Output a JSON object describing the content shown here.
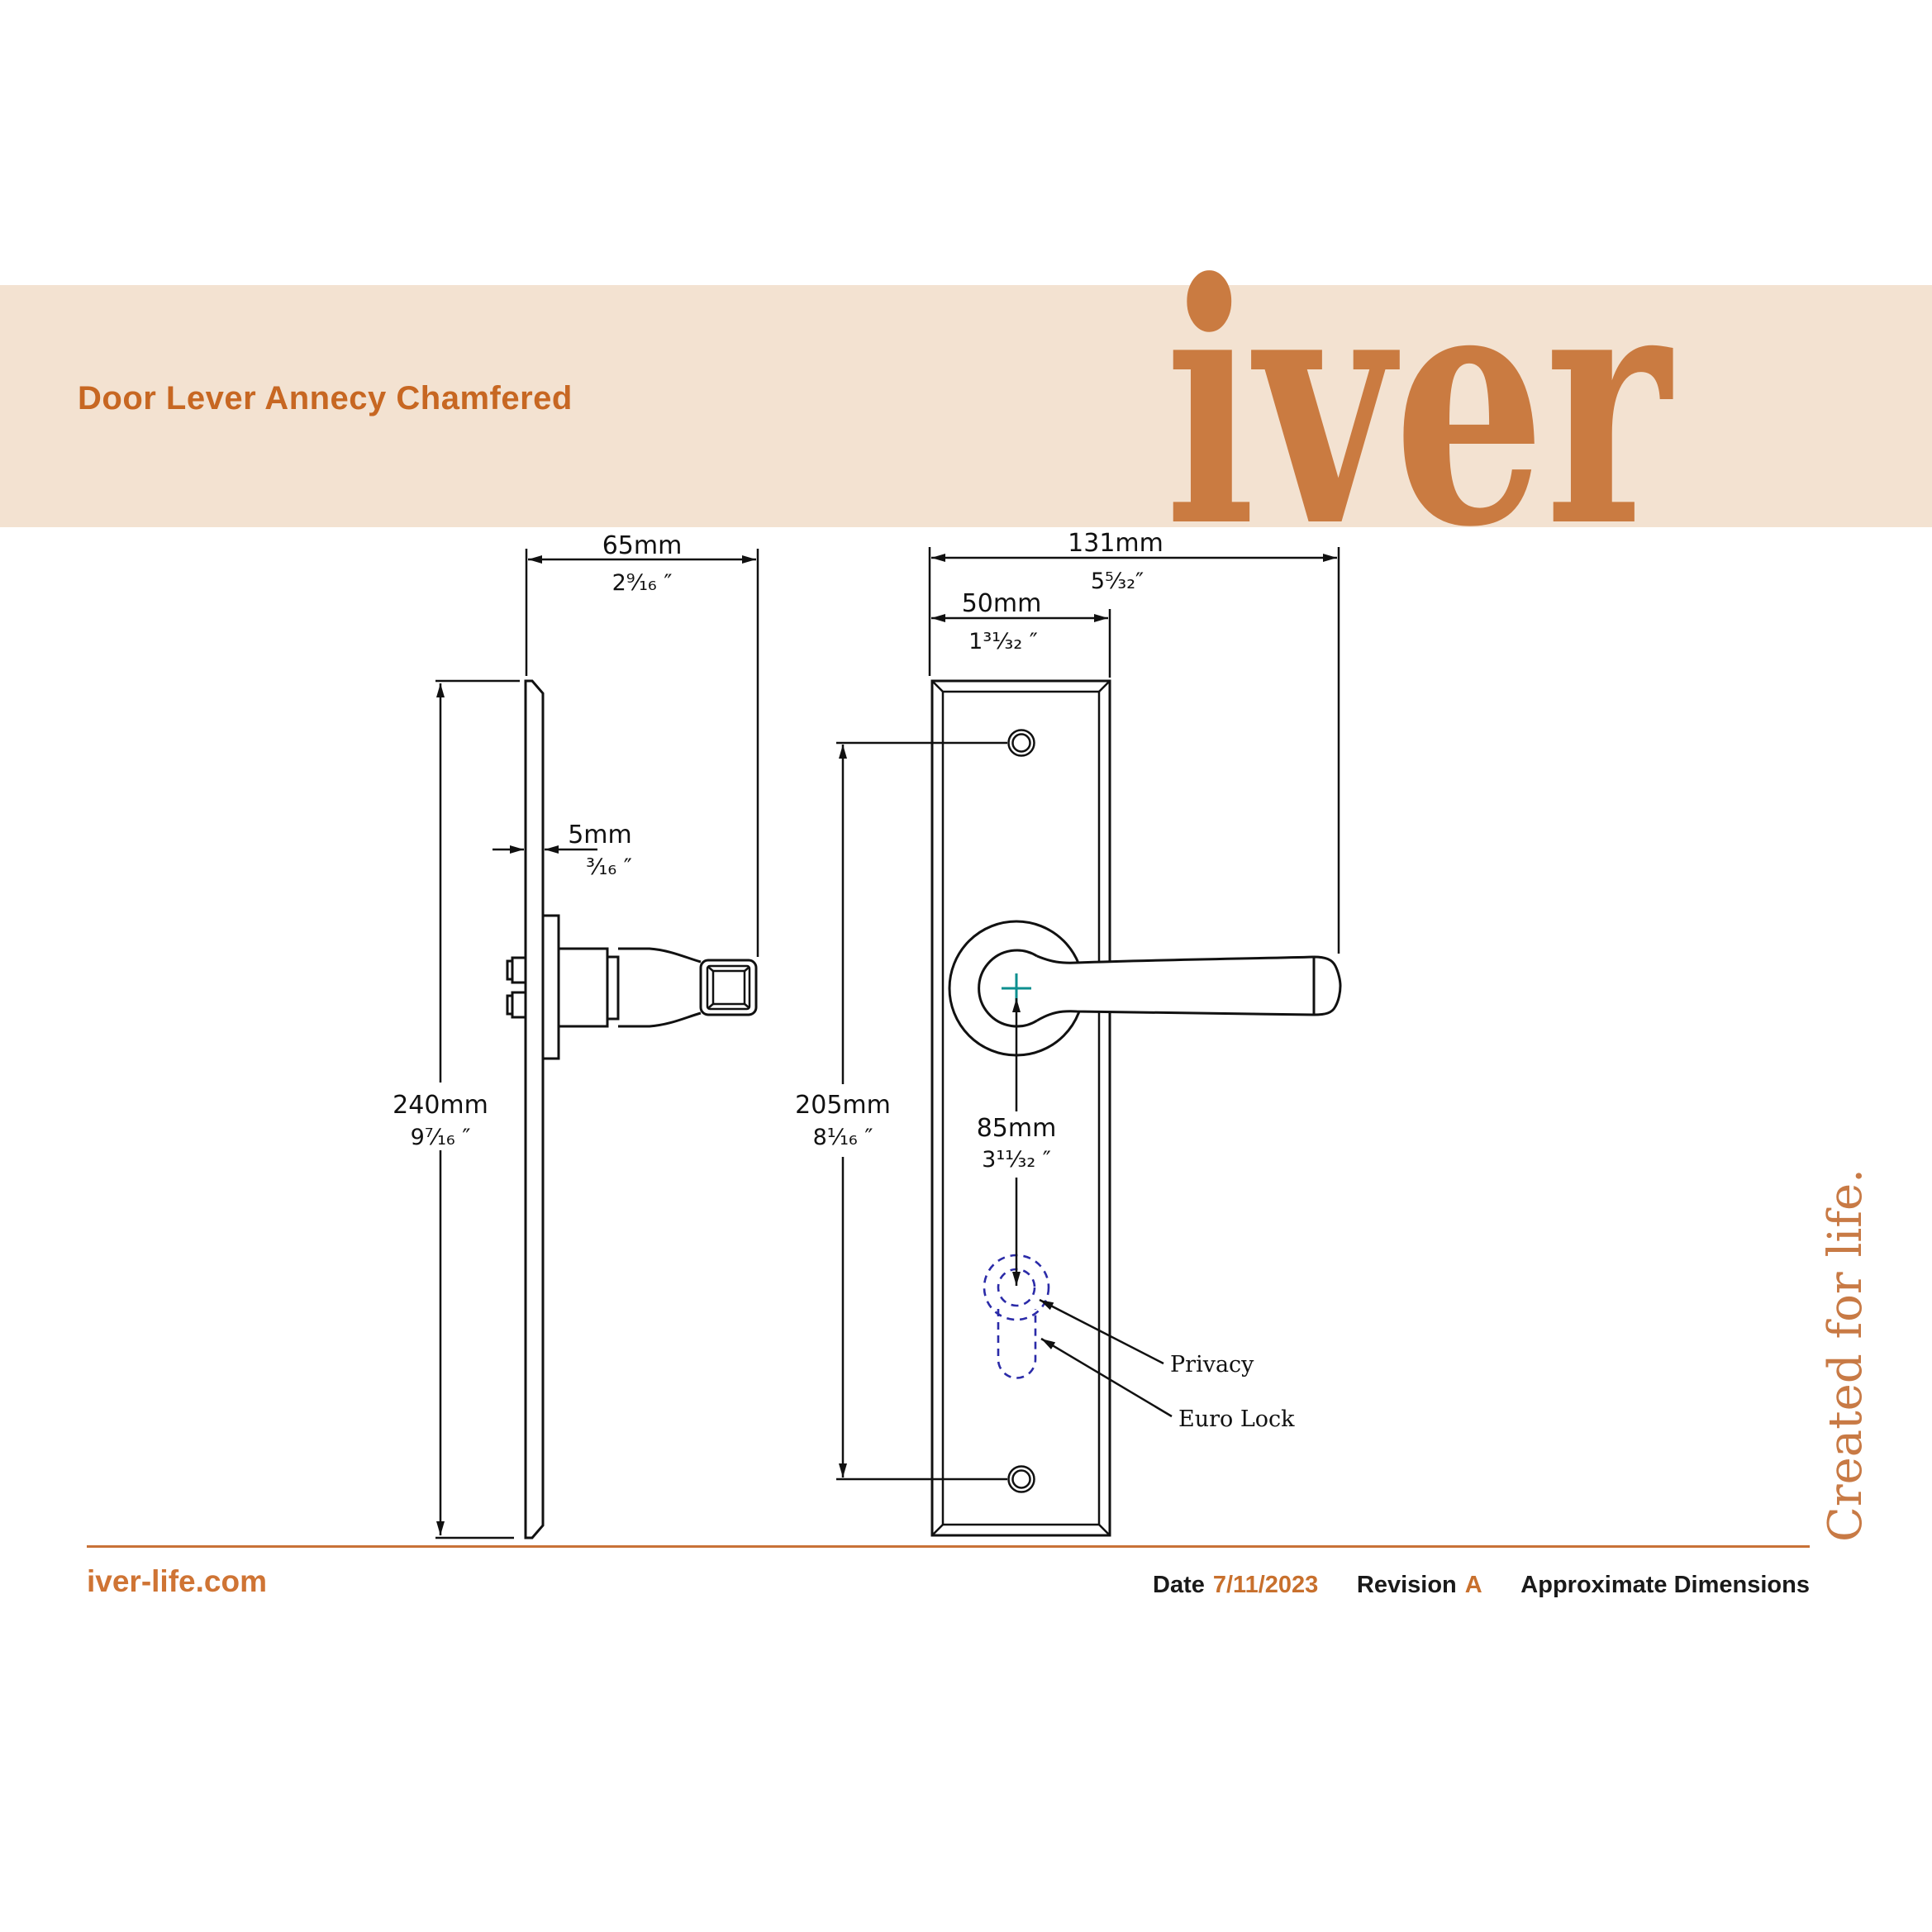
{
  "header": {
    "title": "Door Lever Annecy Chamfered",
    "logo": "iver",
    "tagline": "Created for life."
  },
  "views": {
    "side": {
      "width": {
        "mm": "65mm",
        "inch": "2⁹⁄₁₆ ″"
      },
      "thickness": {
        "mm": "5mm",
        "inch": "³⁄₁₆ ″"
      },
      "height": {
        "mm": "240mm",
        "inch": "9⁷⁄₁₆ ″"
      }
    },
    "front": {
      "total_width": {
        "mm": "131mm",
        "inch": "5⁵⁄₃₂″"
      },
      "plate_width": {
        "mm": "50mm",
        "inch": "1³¹⁄₃₂ ″"
      },
      "hole_spacing": {
        "mm": "205mm",
        "inch": "8¹⁄₁₆ ″"
      },
      "keyhole_offset": {
        "mm": "85mm",
        "inch": "3¹¹⁄₃₂ ″"
      },
      "callouts": {
        "privacy": "Privacy",
        "euro_lock": "Euro Lock"
      }
    }
  },
  "footer": {
    "website": "iver-life.com",
    "date_label": "Date",
    "date_value": "7/11/2023",
    "revision_label": "Revision",
    "revision_value": "A",
    "note": "Approximate Dimensions"
  },
  "colors": {
    "banner": "#f3e2d1",
    "accent": "#c76722",
    "logo_orange": "#ca7b41",
    "footer_rule": "#c87137",
    "centre_cross": "#0d8f8f",
    "keyhole_dashed": "#2b2ba8"
  }
}
